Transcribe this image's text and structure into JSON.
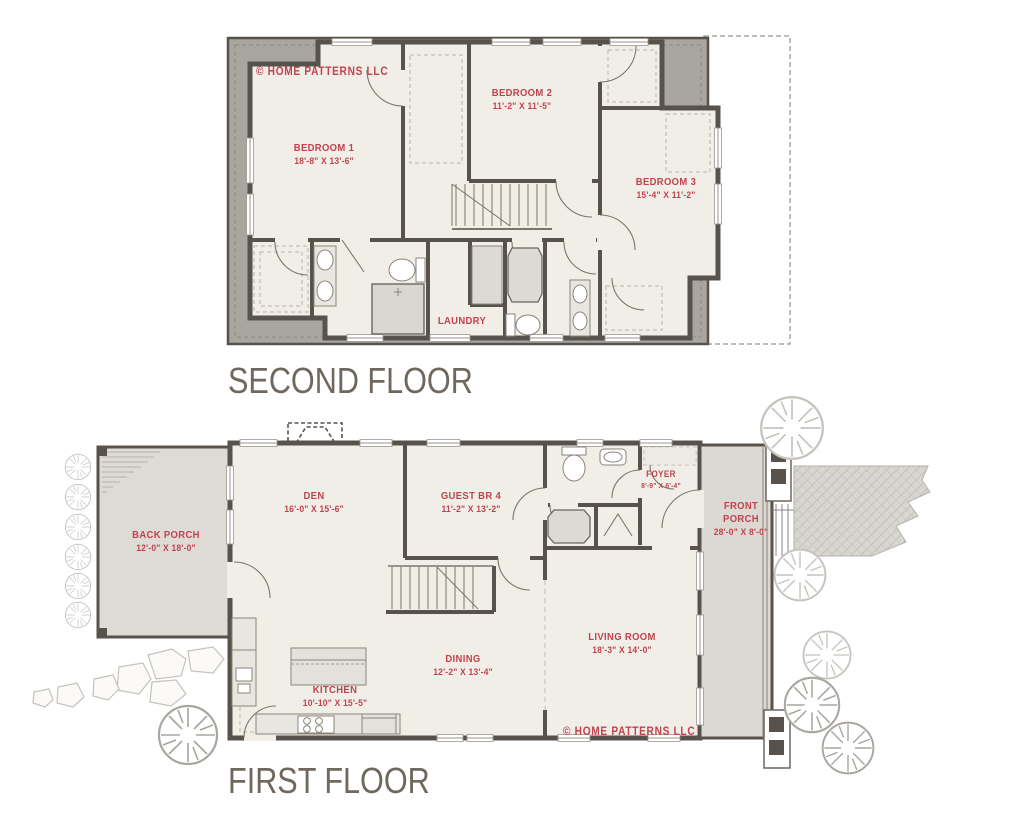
{
  "page": {
    "second_floor_title": "SECOND FLOOR",
    "first_floor_title": "FIRST FLOOR"
  },
  "branding": {
    "copyright_second": "© HOME PATTERNS LLC",
    "copyright_first": "© HOME PATTERNS LLC"
  },
  "second_floor": {
    "rooms": [
      {
        "name": "BEDROOM 1",
        "dims": "18'-8\" X 13'-6\""
      },
      {
        "name": "BEDROOM 2",
        "dims": "11'-2\" X 11'-5\""
      },
      {
        "name": "BEDROOM 3",
        "dims": "15'-4\" X 11'-2\""
      }
    ],
    "laundry_label": "LAUNDRY"
  },
  "first_floor": {
    "rooms": [
      {
        "name": "BACK PORCH",
        "dims": "12'-0\" X 18'-0\""
      },
      {
        "name": "DEN",
        "dims": "16'-0\" X 15'-6\""
      },
      {
        "name": "GUEST BR 4",
        "dims": "11'-2\" X 13'-2\""
      },
      {
        "name": "FOYER",
        "dims": "8'-9\" X 6'-4\""
      },
      {
        "name": "FRONT PORCH",
        "dims": "28'-0\" X 8'-0\""
      },
      {
        "name": "LIVING ROOM",
        "dims": "18'-3\" X 14'-0\""
      },
      {
        "name": "DINING",
        "dims": "12'-2\" X 13'-4\""
      },
      {
        "name": "KITCHEN",
        "dims": "10'-10\" X 15'-5\""
      }
    ]
  },
  "colors": {
    "label_red": "#c2424e",
    "title_gray": "#6f685e",
    "wall": "#57524b",
    "roof_band": "#a9a59f",
    "floor_fill": "#f1eee8",
    "porch_fill": "#dedbd5"
  }
}
